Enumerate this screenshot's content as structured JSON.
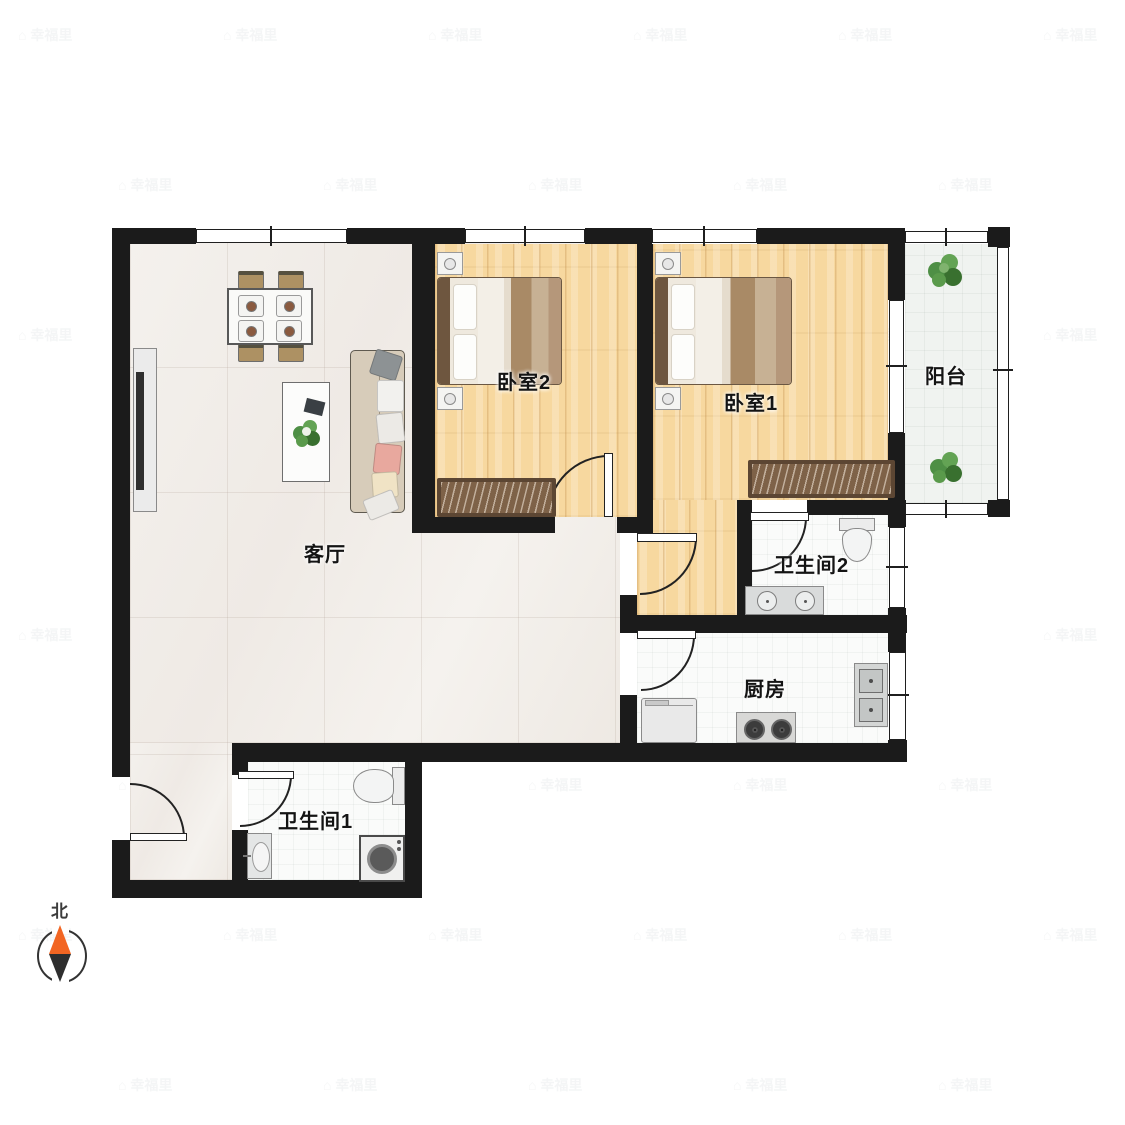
{
  "plan_type": "floor-plan",
  "rooms": {
    "living": {
      "label": "客厅"
    },
    "bedroom1": {
      "label": "卧室1"
    },
    "bedroom2": {
      "label": "卧室2"
    },
    "balcony": {
      "label": "阳台"
    },
    "bathroom1": {
      "label": "卫生间1"
    },
    "bathroom2": {
      "label": "卫生间2"
    },
    "kitchen": {
      "label": "厨房"
    }
  },
  "compass": {
    "north_label": "北"
  },
  "watermark": {
    "text": "幸福里",
    "house_glyph": "⌂"
  },
  "colors": {
    "wall": "#1b1b1b",
    "wood_floor": "#f7d89f",
    "tile_floor": "#f2efeb",
    "compass_north": "#f26522",
    "compass_south": "#2e2e2e",
    "plant_green": "#4e8f45",
    "wardrobe_brown": "#7e6248"
  }
}
